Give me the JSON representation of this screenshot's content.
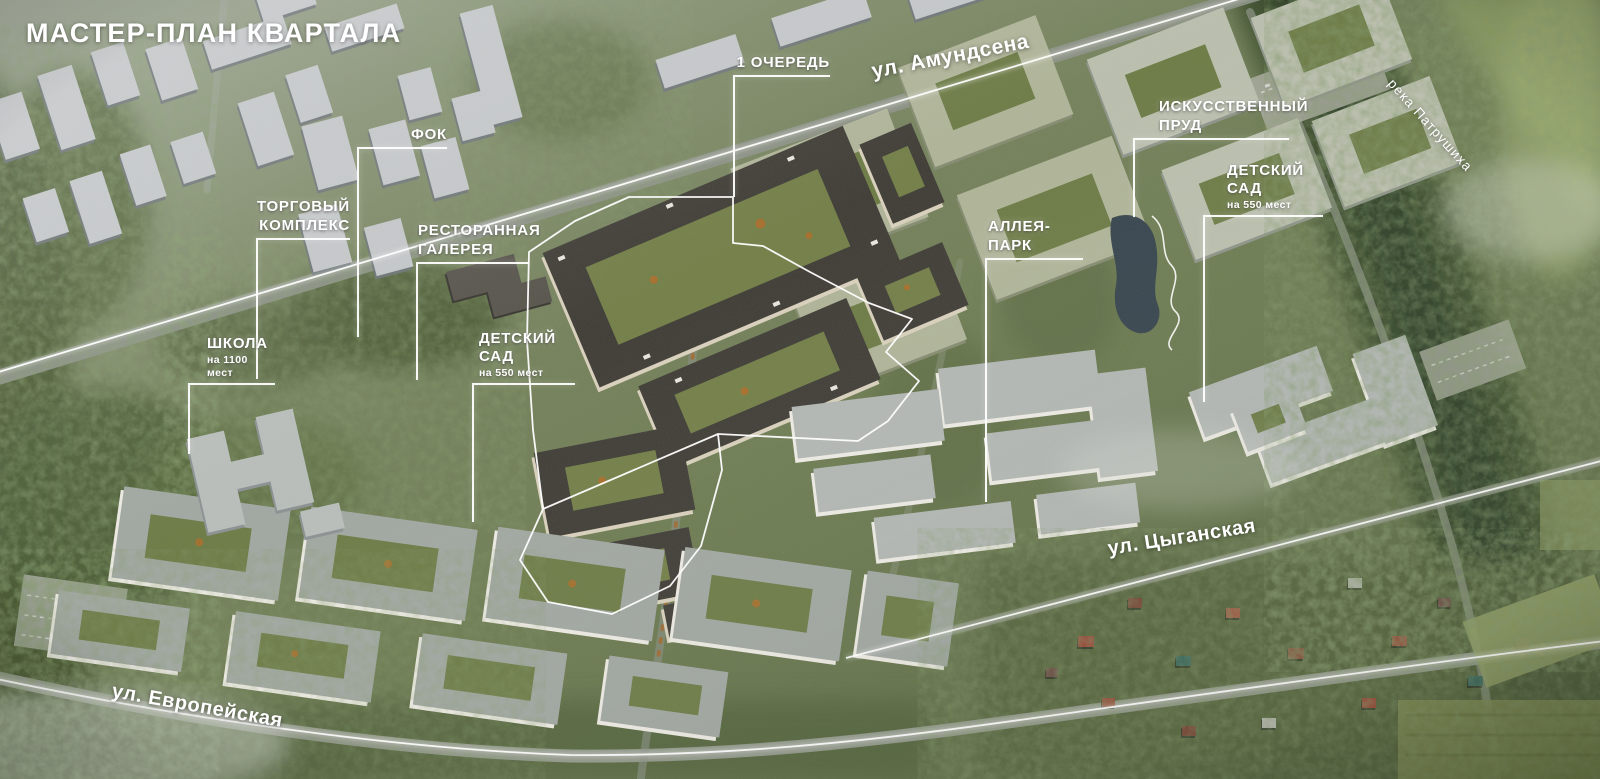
{
  "title": "МАСТЕР-ПЛАН КВАРТАЛА",
  "callouts": {
    "phase1": {
      "label": "1 ОЧЕРЕДЬ"
    },
    "fok": {
      "label": "ФОК"
    },
    "shopping_center": {
      "label": "ТОРГОВЫЙ\nКОМПЛЕКС"
    },
    "restaurant_gallery": {
      "label": "РЕСТОРАННАЯ\nГАЛЕРЕЯ"
    },
    "artificial_pond": {
      "label": "ИСКУССТВЕННЫЙ\nПРУД"
    },
    "kindergarten_right": {
      "label": "ДЕТСКИЙ САД",
      "sublabel": "на 550 мест"
    },
    "alley_park": {
      "label": "АЛЛЕЯ-ПАРК"
    },
    "school": {
      "label": "ШКОЛА",
      "sublabel": "на 1100 мест"
    },
    "kindergarten_left": {
      "label": "ДЕТСКИЙ САД",
      "sublabel": "на 550 мест"
    }
  },
  "streets": {
    "amundsena": "ул. Амундсена",
    "tsyganskaya": "ул. Цыганская",
    "evropeyskaya": "ул. Европейская",
    "river_patrushikha": "река Патрушиха"
  },
  "colors": {
    "annotation": "#ffffff",
    "phase1_roof": "#43403a",
    "phase1_wall": "#d9d1bd",
    "pond_water": "#3a4750",
    "foliage": "#4e5e37"
  }
}
